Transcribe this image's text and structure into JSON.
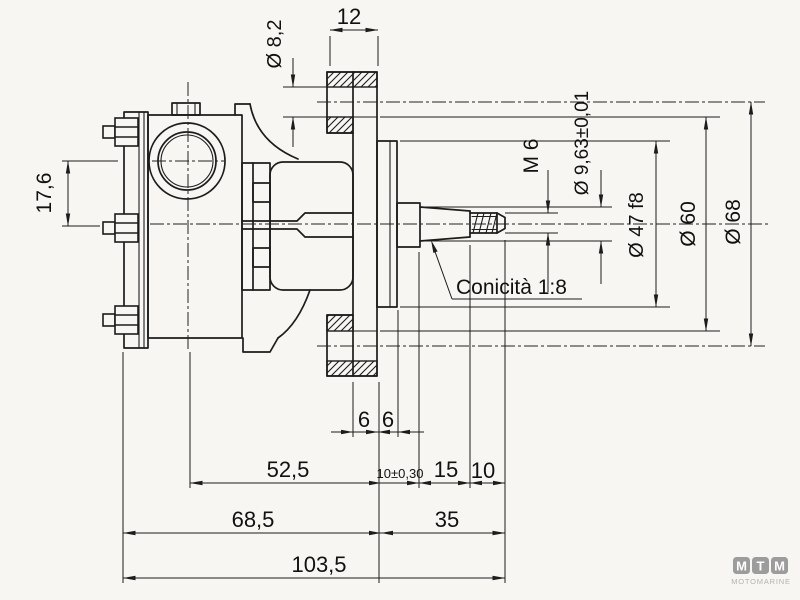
{
  "dimensions": {
    "port_offset": "17,6",
    "bolt_hole_diameter": "Ø 8,2",
    "flange_thickness": "12",
    "thread_size": "M 6",
    "taper_gauge_diameter": "Ø 9,63±0,01",
    "pilot_diameter": "Ø 47 f8",
    "holes_inner_span": "Ø 60",
    "holes_center_span": "Ø 68",
    "flange_step_a": "6",
    "flange_step_b": "6",
    "port_to_flange": "52,5",
    "flange_to_taper": "10±0,30",
    "taper_length": "15",
    "thread_length": "10",
    "body_length": "68,5",
    "shaft_overhang": "35",
    "overall_length": "103,5"
  },
  "annotations": {
    "taper_note": "Conicità 1:8"
  },
  "logo": {
    "letters": [
      "M",
      "T",
      "M"
    ],
    "subtitle": "MOTOMARINE"
  },
  "colors": {
    "line": "#1c1c1c",
    "paper": "#f7f6f2",
    "logo_badge": "#9c9c9c",
    "logo_text": "#b3b3b3"
  }
}
